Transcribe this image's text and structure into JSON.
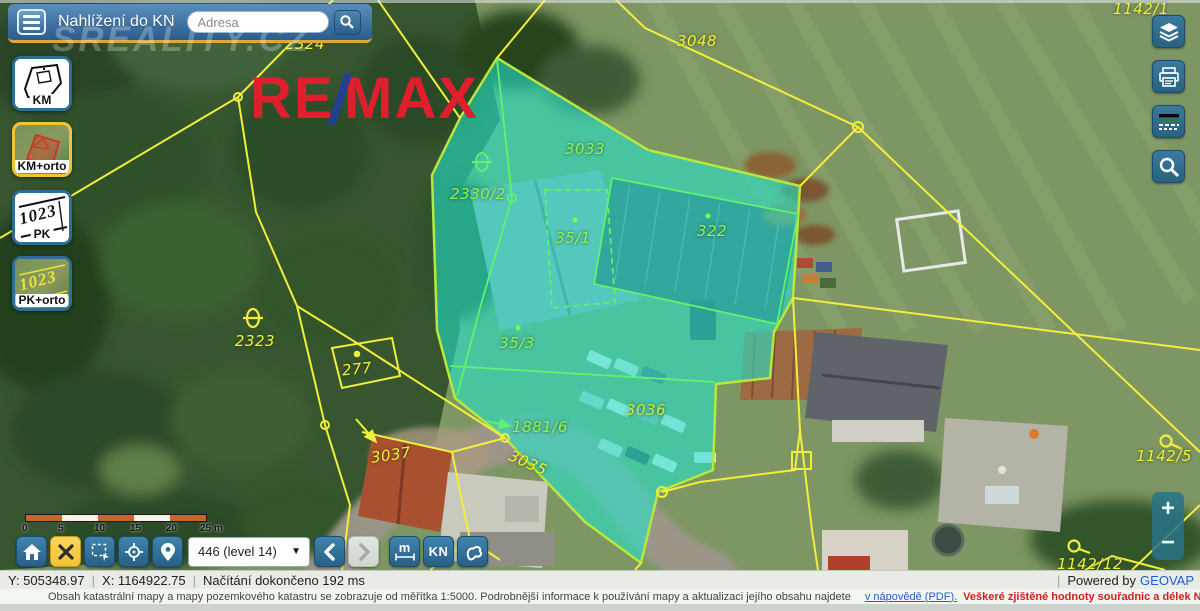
{
  "header": {
    "title": "Nahlížení do KN",
    "address_placeholder": "Adresa",
    "watermark": "SREALITY.CZ"
  },
  "remax": {
    "re": "RE",
    "slash": "/",
    "max": "MAX"
  },
  "map_type_buttons": [
    {
      "label": "KM",
      "selected": false
    },
    {
      "label": "KM+orto",
      "selected": true
    },
    {
      "label": "PK",
      "selected": false
    },
    {
      "label": "PK+orto",
      "selected": false
    }
  ],
  "right_toolbar_icons": [
    "layers-icon",
    "print-icon",
    "scale-preview-icon",
    "magnifier-icon"
  ],
  "zoom_controls": {
    "zoom_in": "+",
    "zoom_out": "−"
  },
  "scale_bar": {
    "labels": [
      "0",
      "5",
      "10",
      "15",
      "20",
      "25 m"
    ],
    "label_x": [
      0,
      36,
      72,
      108,
      144,
      178
    ],
    "segments": 5
  },
  "bottom_toolbar": {
    "dropdown_value": "446 (level 14)",
    "measure_label": "m",
    "kn_label": "KN",
    "buttons": [
      "home",
      "close",
      "select-area",
      "locate",
      "marker",
      "level-dropdown",
      "back",
      "forward",
      "measure",
      "kn",
      "polygon-info"
    ]
  },
  "status_bar": {
    "y_coord": "Y: 505348.97",
    "x_coord": "X: 1164922.75",
    "loading": "Načítání dokončeno 192 ms",
    "powered_prefix": "Powered by",
    "powered_brand": "GEOVAP"
  },
  "info_bar": {
    "text": "Obsah katastrální mapy a mapy pozemkového katastru se zobrazuje od měřítka 1:5000. Podrobnější informace k používání mapy a aktualizaci jejího obsahu najdete",
    "link": "v nápovědě (PDF).",
    "warning": "Veškeré zjištěné hodnoty souřadnic a délek NELZE využívat pro vytyčování hranic pozemků v terénu."
  },
  "map": {
    "highlight_fill": "#23e6cd",
    "parcel_labels": [
      {
        "text": "2324",
        "x": 305,
        "y": 44,
        "color": "yellow",
        "rot": 0
      },
      {
        "text": "3048",
        "x": 697,
        "y": 41,
        "color": "yellow",
        "rot": 0
      },
      {
        "text": "1142/1",
        "x": 1141,
        "y": 9,
        "color": "yellow",
        "rot": 0
      },
      {
        "text": "2323",
        "x": 255,
        "y": 341,
        "color": "yellow",
        "rot": 0
      },
      {
        "text": "277",
        "x": 357,
        "y": 369,
        "color": "yellow",
        "rot": -6
      },
      {
        "text": "3037",
        "x": 391,
        "y": 455,
        "color": "yellow",
        "rot": -8
      },
      {
        "text": "3035",
        "x": 528,
        "y": 463,
        "color": "yellow",
        "rot": 24
      },
      {
        "text": "1142/5",
        "x": 1164,
        "y": 456,
        "color": "yellow",
        "rot": 0
      },
      {
        "text": "1142/12",
        "x": 1090,
        "y": 564,
        "color": "yellow",
        "rot": 0
      },
      {
        "text": "3033",
        "x": 585,
        "y": 149,
        "color": "green",
        "rot": 0
      },
      {
        "text": "2330/2",
        "x": 478,
        "y": 194,
        "color": "green",
        "rot": 0
      },
      {
        "text": "35/1",
        "x": 573,
        "y": 238,
        "color": "green",
        "rot": 0
      },
      {
        "text": "322",
        "x": 712,
        "y": 231,
        "color": "green",
        "rot": 0
      },
      {
        "text": "35/3",
        "x": 517,
        "y": 343,
        "color": "green",
        "rot": 0
      },
      {
        "text": "1881/6",
        "x": 540,
        "y": 427,
        "color": "green",
        "rot": 0
      },
      {
        "text": "3036",
        "x": 646,
        "y": 410,
        "color": "lime",
        "rot": 0
      }
    ]
  },
  "colors": {
    "parcel_yellow": "#eef23a",
    "parcel_green": "#86fa55",
    "parcel_lime": "#c3ef45",
    "cadastral_line": "#f2ee3b",
    "highlight_border": "#b9e83c",
    "header_blue": "#2a5c8e",
    "button_blue": "#2f7095",
    "selected_yellow": "#f0c335",
    "remax_red": "#df1f2d",
    "remax_blue": "#23418f"
  }
}
